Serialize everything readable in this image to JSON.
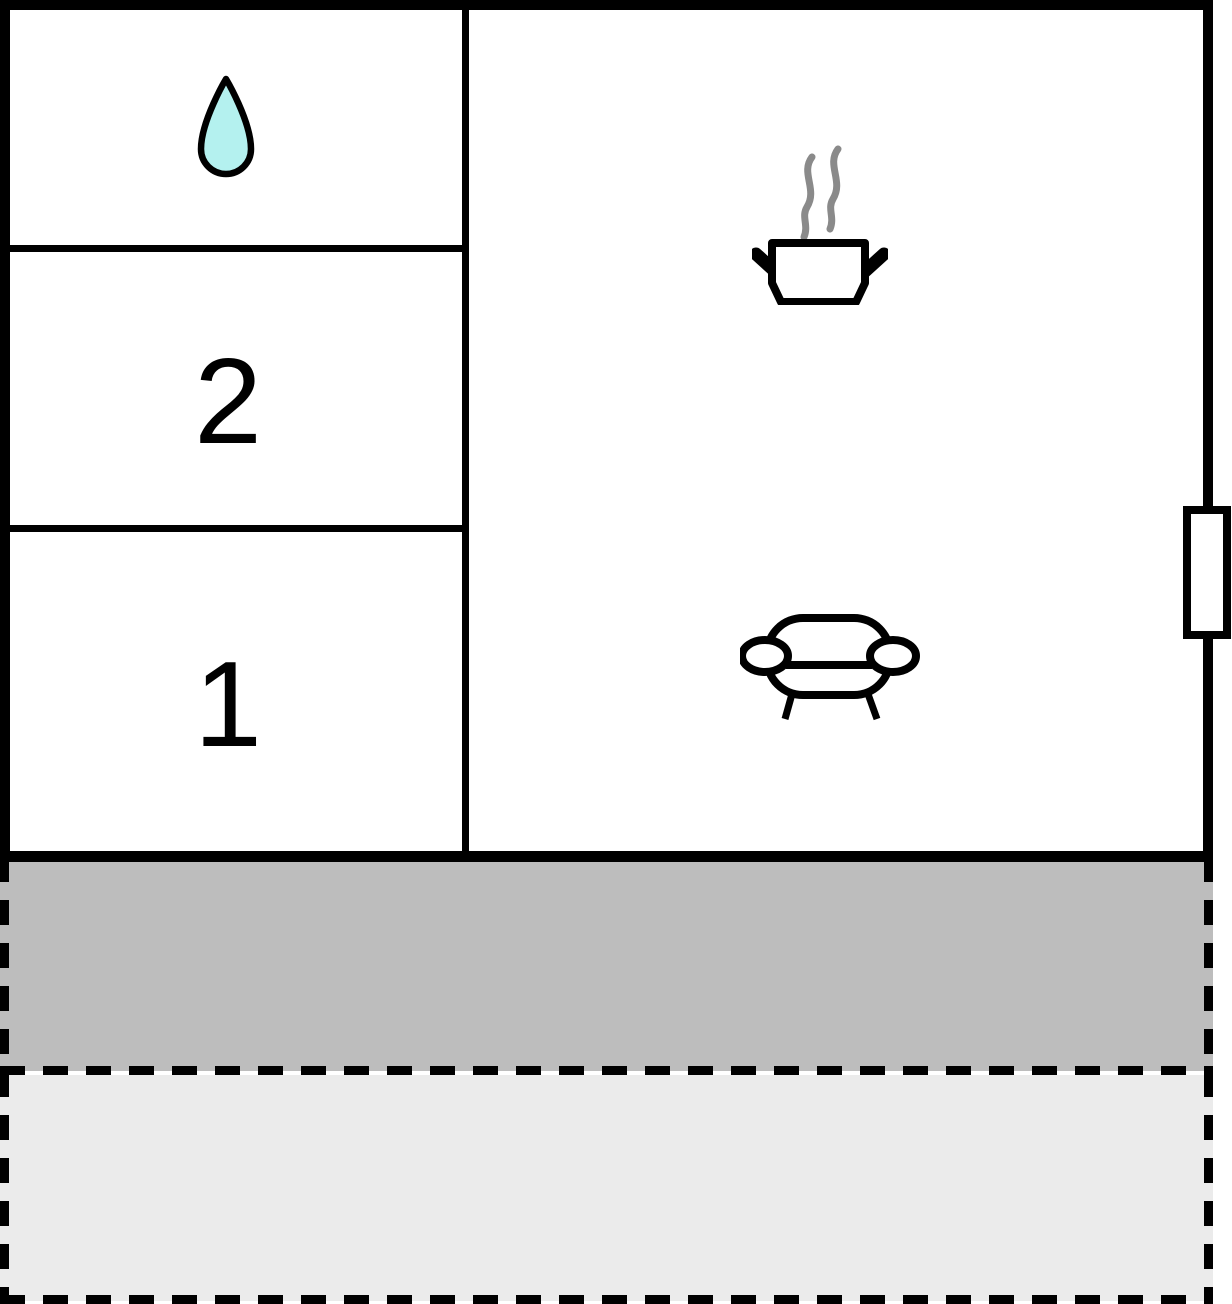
{
  "plan": {
    "rooms": {
      "bathroom": {
        "icon": "water-drop-icon"
      },
      "bedroom2": {
        "label": "2"
      },
      "bedroom1": {
        "label": "1"
      },
      "living_kitchen": {
        "icons": [
          "cooking-pot-icon",
          "steam-icon",
          "sofa-icon"
        ]
      }
    },
    "window_marker": {
      "icon": "window-icon"
    }
  },
  "terrace": {
    "bands": [
      {
        "id": "upper-band",
        "fill": "#bdbdbd",
        "outline": "dashed"
      },
      {
        "id": "lower-band",
        "fill": "#ebebeb",
        "outline": "dashed"
      }
    ]
  },
  "colors": {
    "wall": "#000000",
    "room_fill": "#ffffff",
    "water_drop_fill": "#b4f1ef",
    "steam": "#8a8a8a",
    "terrace_upper": "#bdbdbd",
    "terrace_lower": "#ebebeb",
    "dashed_outline": "#000000"
  }
}
